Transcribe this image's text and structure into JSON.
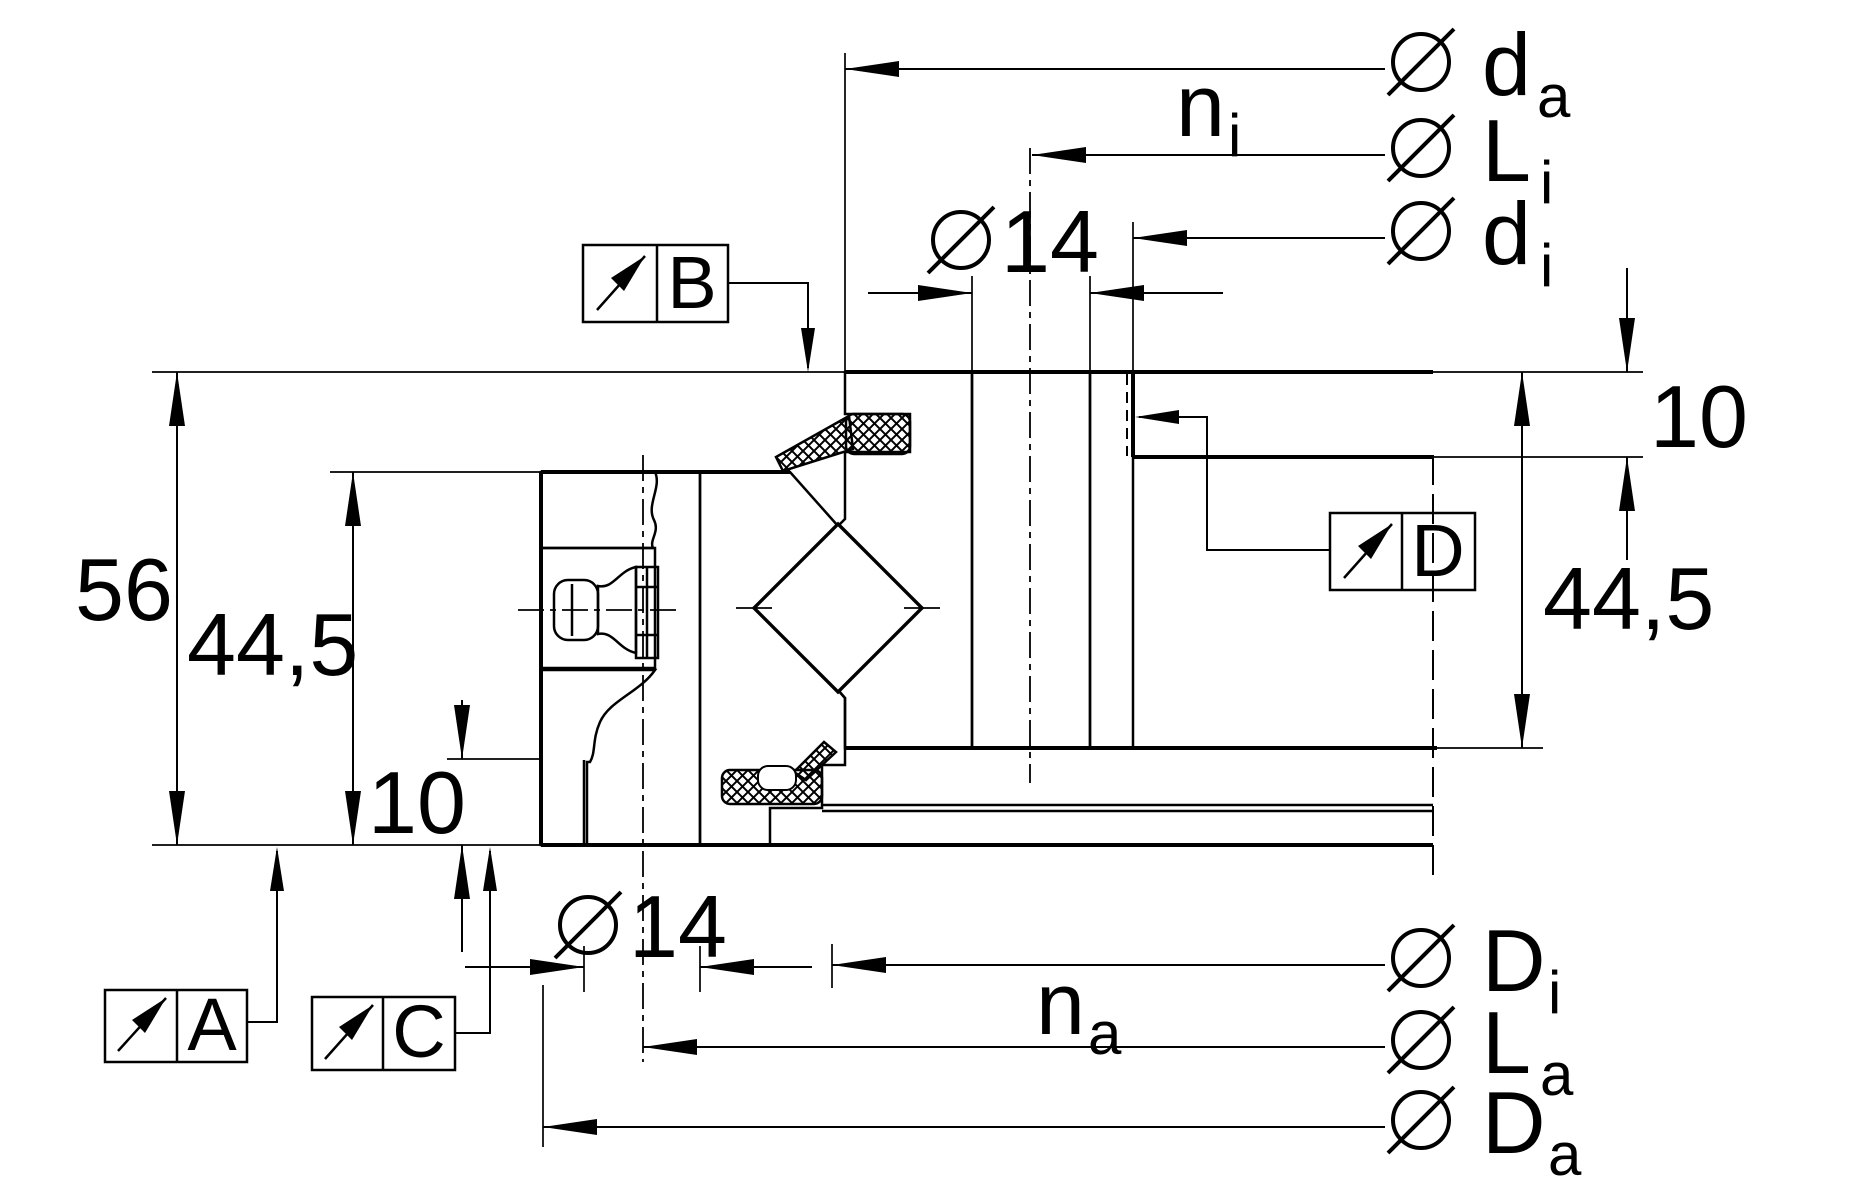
{
  "title": "Slewing ring bearing cross-section technical drawing",
  "colors": {
    "ink": "#000000",
    "paper": "#ffffff"
  },
  "dimensions": {
    "total_height": "56",
    "inner_ring_height": "44,5",
    "outer_ring_height": "44,5",
    "recess_left": "10",
    "recess_right": "10",
    "bolt_hole_top": "14",
    "bolt_hole_bottom": "14"
  },
  "diameter_labels": {
    "d_a": {
      "main": "d",
      "sub": "a"
    },
    "L_i": {
      "main": "L",
      "sub": "i"
    },
    "d_i": {
      "main": "d",
      "sub": "i"
    },
    "D_i": {
      "main": "D",
      "sub": "i"
    },
    "L_a": {
      "main": "L",
      "sub": "a"
    },
    "D_a": {
      "main": "D",
      "sub": "a"
    }
  },
  "hole_counts": {
    "n_i": {
      "main": "n",
      "sub": "i"
    },
    "n_a": {
      "main": "n",
      "sub": "a"
    }
  },
  "datum_labels": {
    "A": "A",
    "B": "B",
    "C": "C",
    "D": "D"
  }
}
